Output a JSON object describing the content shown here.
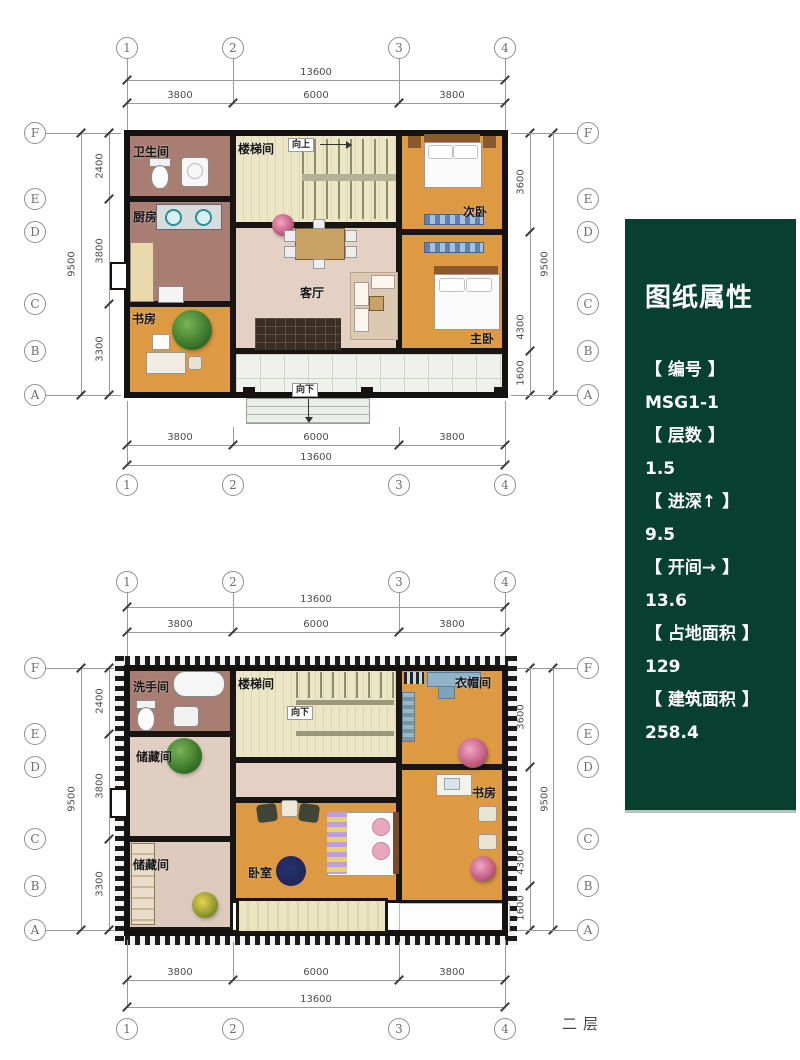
{
  "panel": {
    "title": "图纸属性",
    "items": [
      {
        "label": "【 编号 】",
        "value": "MSG1-1"
      },
      {
        "label": "【 层数 】",
        "value": "1.5"
      },
      {
        "label": "【 进深↑ 】",
        "value": "9.5"
      },
      {
        "label": "【 开间→ 】",
        "value": "13.6"
      },
      {
        "label": "【 占地面积 】",
        "value": "129"
      },
      {
        "label": "【 建筑面积 】",
        "value": "258.4"
      }
    ]
  },
  "grid": {
    "cols": [
      "1",
      "2",
      "3",
      "4"
    ],
    "rows": [
      "F",
      "E",
      "D",
      "C",
      "B",
      "A"
    ],
    "width_total": "13600",
    "width_segments": [
      "3800",
      "6000",
      "3800"
    ],
    "depth_total": "9500",
    "depth_left_segments": [
      "2400",
      "3800",
      "3300"
    ],
    "depth_right_segments": [
      "3600",
      "4300",
      "1600"
    ]
  },
  "floor1": {
    "bathroom": "卫生间",
    "stair": "楼梯间",
    "up": "向上",
    "bedroom2": "次卧",
    "kitchen": "厨房",
    "living": "客厅",
    "study": "书房",
    "master": "主卧",
    "down": "向下"
  },
  "floor2": {
    "washroom": "洗手间",
    "stair": "楼梯间",
    "down": "向下",
    "cloakroom": "衣帽间",
    "storage_mid": "储藏间",
    "storage_bottom": "储藏间",
    "study": "书房",
    "bedroom": "卧室",
    "floor_label": "二层"
  },
  "colors": {
    "panel_green": "#07402e",
    "wall": "#181512",
    "wood_floor": "#dd9a42",
    "wet_room": "#a87d72",
    "stair_floor": "#e8e4c2",
    "living_floor": "#e4d1c4",
    "storage_floor": "#ddcabd",
    "porch_tile": "#eef1ec"
  }
}
